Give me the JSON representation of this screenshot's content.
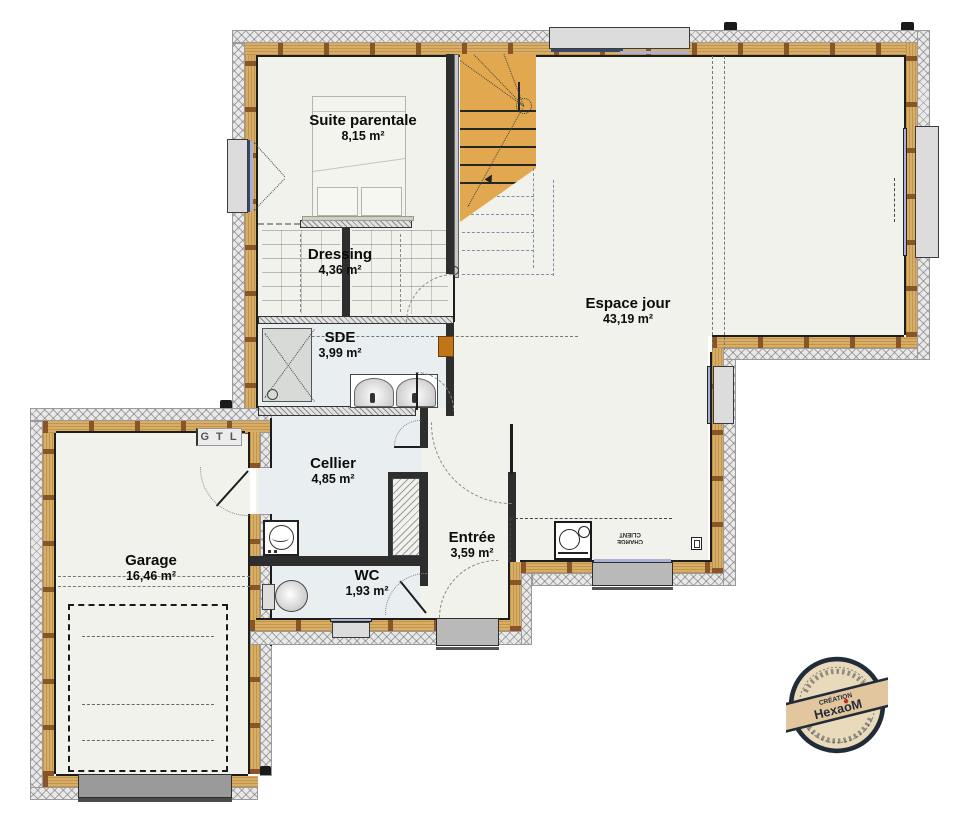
{
  "title": "Plan rez-de-chaussée",
  "rooms": [
    {
      "name": "Suite parentale",
      "area": "8,15 m²"
    },
    {
      "name": "Dressing",
      "area": "4,36 m²"
    },
    {
      "name": "SDE",
      "area": "3,99 m²"
    },
    {
      "name": "Espace jour",
      "area": "43,19 m²"
    },
    {
      "name": "Cellier",
      "area": "4,85 m²"
    },
    {
      "name": "Entrée",
      "area": "3,59 m²"
    },
    {
      "name": "WC",
      "area": "1,93 m²"
    },
    {
      "name": "Garage",
      "area": "16,46 m²"
    }
  ],
  "annotations": {
    "gtl": "G T L",
    "charge_client_line1": "CHARGE",
    "charge_client_line2": "CLIENT"
  },
  "logo": {
    "tagline": "CRÉATION",
    "brand": "HexaoM"
  },
  "colors": {
    "wall_wood": "#d8ae64",
    "wall_stud": "#8a5426",
    "stair": "#e1a84f",
    "glass": "#a9b1d6",
    "door_gray": "#b9b9b9",
    "post_orange": "#c07518",
    "stamp_navy": "#222b38",
    "stamp_beige": "#e9dabc",
    "stamp_dot_red": "#c2302a"
  }
}
